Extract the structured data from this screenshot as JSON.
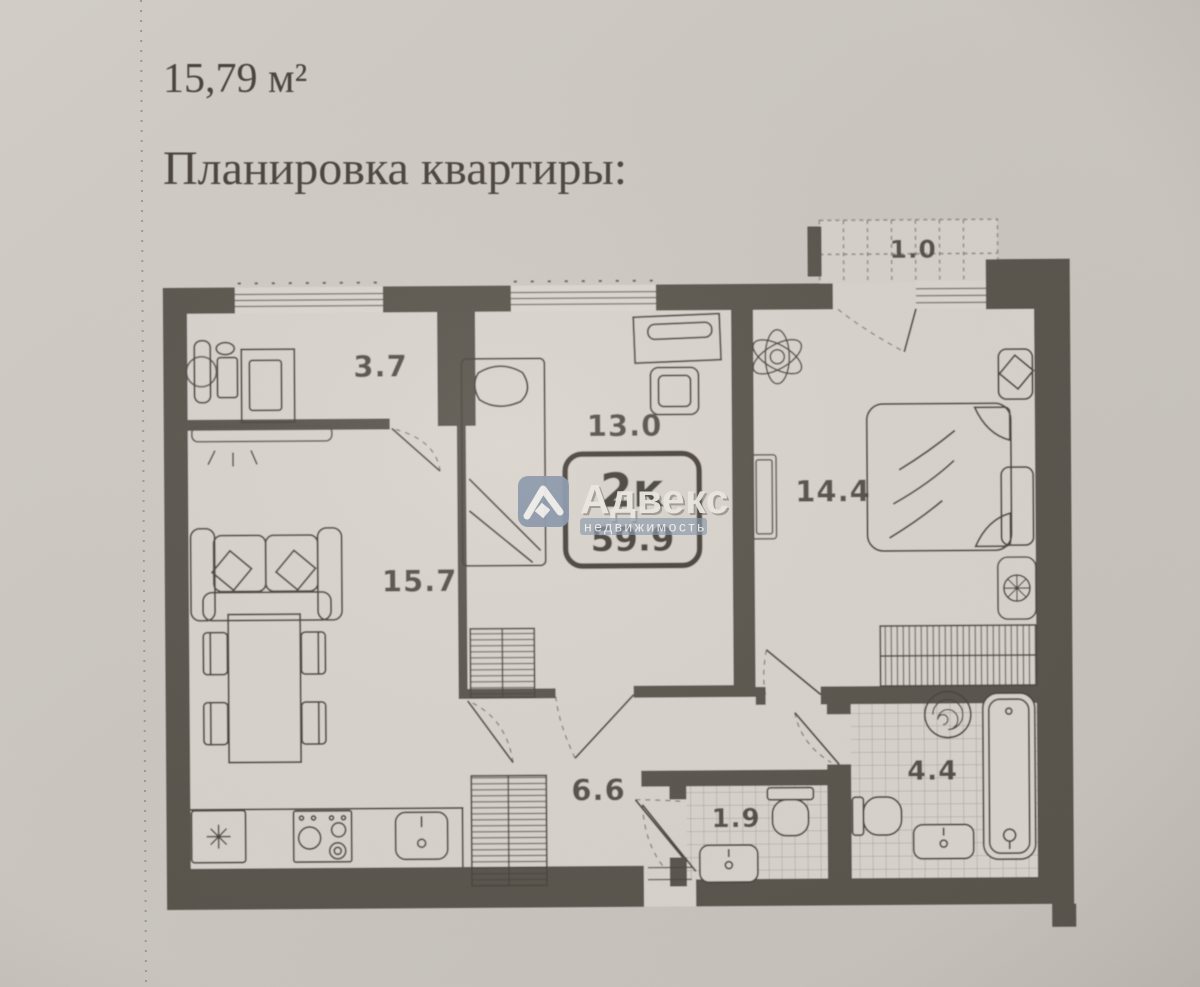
{
  "page": {
    "area_note": "15,79 м²",
    "title": "Планировка квартиры:"
  },
  "badge": {
    "rooms_label": "2к",
    "total_area": "59.9"
  },
  "watermark": {
    "brand": "Адвекс",
    "tagline": "недвижимость"
  },
  "rooms": {
    "loggia": "3.7",
    "bedroom_small": "13.0",
    "bedroom_master": "14.4",
    "living_kitchen": "15.7",
    "hallway": "6.6",
    "wc": "1.9",
    "bathroom": "4.4",
    "balcony": "1.0"
  },
  "colors": {
    "paper": "#cdc7c1",
    "floor": "#d9d4cd",
    "wall": "#59534c",
    "ink": "#433d36",
    "watermark_blue": "#8695aa"
  }
}
